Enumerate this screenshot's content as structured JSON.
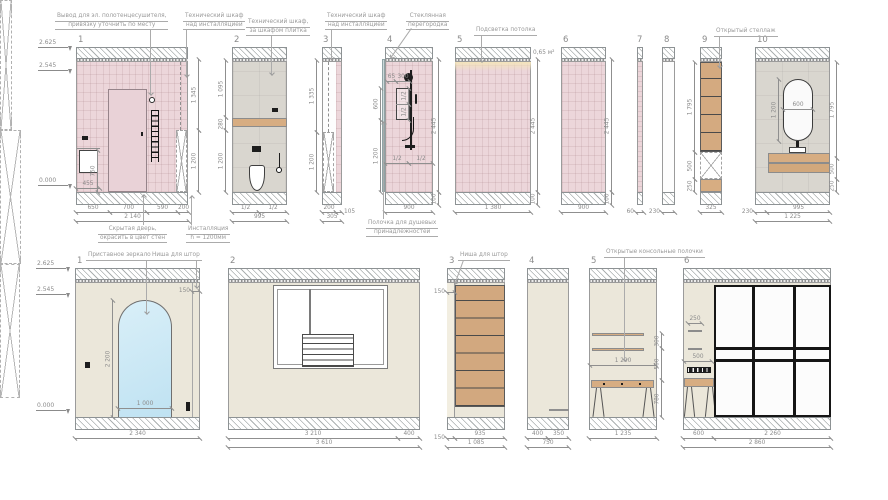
{
  "colors": {
    "tile_pink": "#ecd6da",
    "wall_grey": "#d9d6cf",
    "wall_beige": "#ebe7da",
    "wood": "#d7ad82",
    "glass_blue": "#cfe9f6",
    "frame_black": "#161616",
    "dim_grey": "#8f8f8f"
  },
  "t1": {
    "num": "1",
    "note_towel1": "Вывод для эл. полотенцесушителя,",
    "note_towel2": "привязку уточнить по месту",
    "note_tech1": "Технический шкаф",
    "note_tech2": "над инсталляцией",
    "note_door1": "Скрытая дверь,",
    "note_door2": "окрасить в цвет стен",
    "note_inst1": "Инсталляция",
    "note_inst2": "h = 1200мм",
    "lvl_top": "2.625",
    "lvl_mid": "2.545",
    "lvl_zero": "0.000",
    "d455": "455",
    "d750": "750",
    "r1": "1 345",
    "r2": "1 200",
    "b1": "650",
    "b2": "700",
    "b3": "590",
    "b4": "200",
    "total": "2 140"
  },
  "t2": {
    "num": "2",
    "note1": "Технический шкаф,",
    "note2": "за шкафом плитка",
    "v1": "1 095",
    "v2": "280",
    "v3": "1 200",
    "b1": "1/2",
    "b2": "1/2",
    "total": "995"
  },
  "t3": {
    "num": "3",
    "note1": "Технический шкаф",
    "note2": "над инсталляцией",
    "v1": "1 335",
    "v2": "1 200",
    "b1": "200",
    "b2": "105",
    "total": "305"
  },
  "t4": {
    "num": "4",
    "note1": "Стеклянная",
    "note2": "перегородка",
    "note_shelf1": "Полочка для душевых",
    "note_shelf2": "принадлежностей",
    "d65": "65",
    "d300": "300",
    "d600": "600",
    "n1": "1/2",
    "n2": "1/2",
    "v1200": "1 200",
    "v2445": "2 445",
    "h1": "1/2",
    "h2": "1/2",
    "b900": "900",
    "v100": "100"
  },
  "t5": {
    "num": "5",
    "note": "Подсветка потолка",
    "area": "0,65 м²",
    "v2445": "2 445",
    "v100": "100",
    "total": "1 380"
  },
  "t6": {
    "num": "6",
    "v2445": "2 445",
    "v100": "100",
    "total": "900"
  },
  "t7": {
    "num": "7",
    "total": "60"
  },
  "t8": {
    "num": "8",
    "total": "230"
  },
  "t9": {
    "num": "9",
    "note": "Открытый стеллаж",
    "v1": "1 795",
    "v2": "500",
    "v3": "250",
    "total": "325"
  },
  "t10": {
    "num": "10",
    "d600": "600",
    "v1200": "1 200",
    "v1": "1 795",
    "v2": "500",
    "v3": "250",
    "b1": "230",
    "b2": "995",
    "total": "1 225"
  },
  "b1": {
    "num": "1",
    "note_mirror": "Приставное зеркало",
    "note_niche": "Ниша для штор",
    "lvl_top": "2.625",
    "lvl_mid": "2.545",
    "lvl_zero": "0.000",
    "d150": "150",
    "v2200": "2 200",
    "w1000": "1 000",
    "total": "2 340"
  },
  "b2": {
    "num": "2",
    "s1": "3 210",
    "s2": "400",
    "total": "3 610"
  },
  "b3": {
    "num": "3",
    "note": "Ниша для штор",
    "d150": "150",
    "s1": "150",
    "s2": "935",
    "total": "1 085"
  },
  "b4": {
    "num": "4",
    "s1": "400",
    "s2": "350",
    "total": "750"
  },
  "b5": {
    "num": "5",
    "note": "Открытые консольные полочки",
    "w1200": "1 200",
    "v300": "300",
    "v500": "500",
    "v780": "780",
    "total": "1 235"
  },
  "b6": {
    "num": "6",
    "d250": "250",
    "d500": "500",
    "s1": "600",
    "s2": "2 260",
    "total": "2 860"
  }
}
